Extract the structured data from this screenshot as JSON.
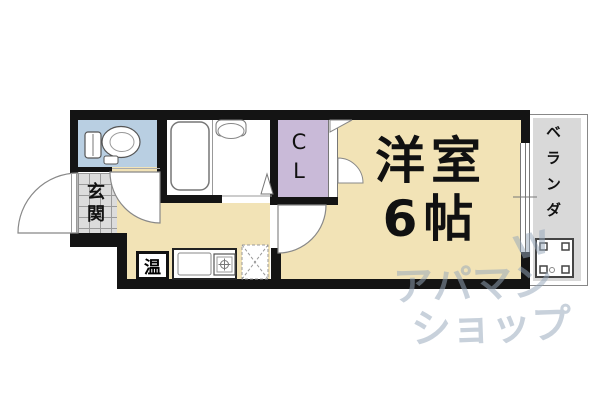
{
  "rooms": {
    "main": {
      "line1": "洋室",
      "line2": "6帖"
    },
    "closet": {
      "c1": "C",
      "c2": "L"
    },
    "entrance": {
      "c1": "玄",
      "c2": "関"
    },
    "veranda": {
      "label": "ベランダ"
    },
    "heater": {
      "label": "温"
    }
  },
  "watermark": {
    "line1": "アパマン",
    "line2": "ショップ",
    "mark": "W"
  },
  "colors": {
    "room_beige": "#f2e3b6",
    "toilet_blue": "#b9cfe2",
    "closet_purple": "#c9bad8",
    "tile_gray": "#dcdcdc",
    "veranda_gray": "#d9d9d9",
    "wall_black": "#141414"
  }
}
